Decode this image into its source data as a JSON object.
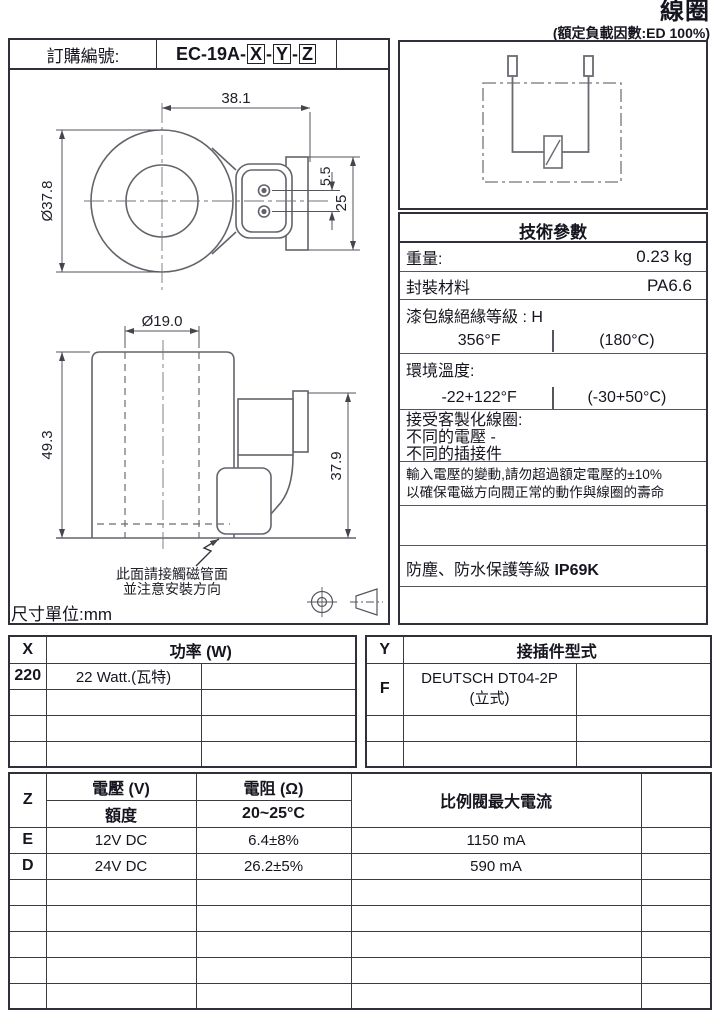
{
  "header": {
    "title": "線圈",
    "subtitle": "(額定負載因數:ED 100%)"
  },
  "order": {
    "label": "訂購編號:",
    "code_prefix": "EC-19A-",
    "code_x": "X",
    "code_y": "Y",
    "code_z": "Z"
  },
  "drawing": {
    "unit_label": "尺寸單位:mm",
    "note_line1": "此面請接觸磁管面",
    "note_line2": "並注意安裝方向",
    "dims": {
      "top_width": "38.1",
      "coil_diameter": "Ø37.8",
      "pin_pitch": "5.5",
      "connector_width": "25",
      "tube_diameter": "Ø19.0",
      "coil_height": "49.3",
      "connector_height": "37.9"
    }
  },
  "tech_params": {
    "title": "技術參數",
    "weight_label": "重量:",
    "weight_value": "0.23 kg",
    "material_label": "封裝材料",
    "material_value": "PA6.6",
    "insulation_label": "漆包線絕緣等級 : H",
    "insulation_f": "356°F",
    "insulation_c": "(180°C)",
    "ambient_label": "環境溫度:",
    "ambient_f": "-22+122°F",
    "ambient_c": "(-30+50°C)",
    "custom_line1": "接受客製化線圈:",
    "custom_line2": "不同的電壓 -",
    "custom_line3": "不同的插接件",
    "warning_line1": "輸入電壓的變動,請勿超過額定電壓的±10%",
    "warning_line2": "以確保電磁方向閥正常的動作與線圈的壽命",
    "protection_label": "防塵、防水保護等級",
    "protection_value": "IP69K"
  },
  "power_table": {
    "code_header": "X",
    "label_header": "功率 (W)",
    "row1_code": "220",
    "row1_value": "22 Watt.(瓦特)"
  },
  "connector_table": {
    "code_header": "Y",
    "label_header": "接插件型式",
    "row1_code": "F",
    "row1_value_line1": "DEUTSCH DT04-2P",
    "row1_value_line2": "(立式)"
  },
  "voltage_table": {
    "code_header": "Z",
    "voltage_header": "電壓 (V)",
    "voltage_subheader": "額度",
    "resistance_header": "電阻 (Ω)",
    "resistance_subheader": "20~25°C",
    "current_header": "比例閥最大電流",
    "rows": [
      {
        "code": "E",
        "voltage": "12V DC",
        "resistance": "6.4±8%",
        "current": "1150 mA"
      },
      {
        "code": "D",
        "voltage": "24V DC",
        "resistance": "26.2±5%",
        "current": "590 mA"
      }
    ]
  }
}
